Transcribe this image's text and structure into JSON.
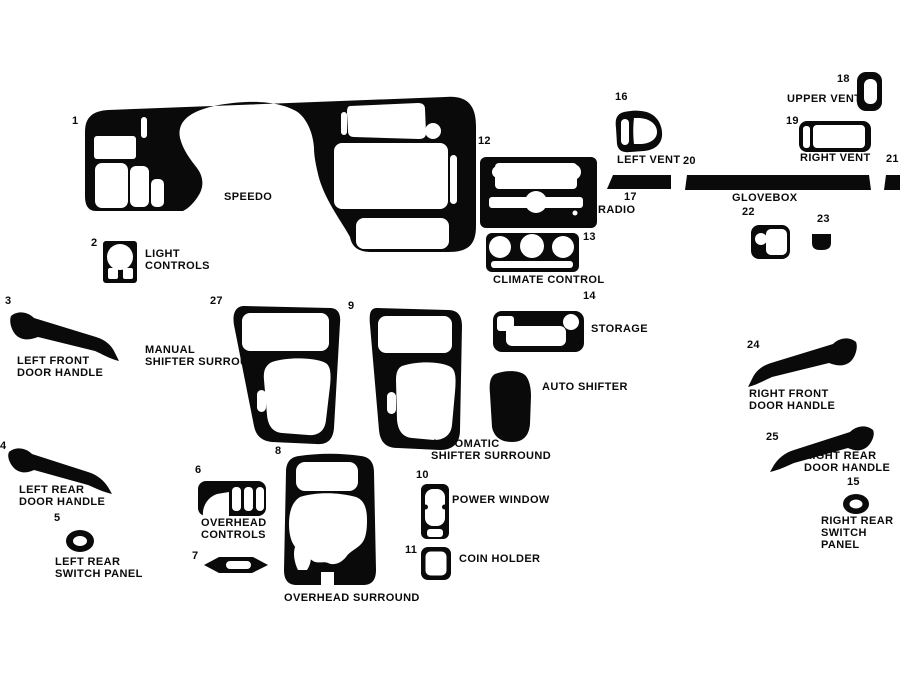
{
  "colors": {
    "background": "#ffffff",
    "ink": "#0a0a0a"
  },
  "parts": {
    "speedo": {
      "number": "1",
      "label": "SPEEDO"
    },
    "light_controls": {
      "number": "2",
      "label": "LIGHT\nCONTROLS"
    },
    "left_front_door_handle": {
      "number": "3",
      "label": "LEFT FRONT\nDOOR HANDLE"
    },
    "left_rear_door_handle": {
      "number": "4",
      "label": "LEFT REAR\nDOOR HANDLE"
    },
    "left_rear_switch_panel": {
      "number": "5",
      "label": "LEFT REAR\nSWITCH PANEL"
    },
    "overhead_controls": {
      "number": "6",
      "label": "OVERHEAD\nCONTROLS"
    },
    "strip_7": {
      "number": "7"
    },
    "overhead_surround": {
      "number": "8",
      "label": "OVERHEAD SURROUND"
    },
    "automatic_shifter_surround": {
      "number": "9",
      "label": "AUTOMATIC\nSHIFTER SURROUND"
    },
    "power_window": {
      "number": "10",
      "label": "POWER WINDOW"
    },
    "coin_holder": {
      "number": "11",
      "label": "COIN HOLDER"
    },
    "radio": {
      "number": "12",
      "label": "RADIO"
    },
    "climate_control": {
      "number": "13",
      "label": "CLIMATE CONTROL"
    },
    "storage": {
      "number": "14",
      "label": "STORAGE"
    },
    "right_rear_switch_panel": {
      "number": "15",
      "label": "RIGHT REAR\nSWITCH PANEL"
    },
    "left_vent": {
      "number": "16",
      "label": "LEFT VENT"
    },
    "strip_17": {
      "number": "17"
    },
    "upper_vent": {
      "number": "18",
      "label": "UPPER VENT"
    },
    "right_vent": {
      "number": "19",
      "label": "RIGHT VENT"
    },
    "glovebox": {
      "number": "20",
      "label": "GLOVEBOX"
    },
    "strip_21": {
      "number": "21"
    },
    "pocket_22": {
      "number": "22"
    },
    "pocket_23": {
      "number": "23"
    },
    "right_front_door_handle": {
      "number": "24",
      "label": "RIGHT FRONT\nDOOR HANDLE"
    },
    "right_rear_door_handle": {
      "number": "25",
      "label": "RIGHT REAR\nDOOR HANDLE"
    },
    "manual_shifter_surround": {
      "number": "27",
      "label": "MANUAL\nSHIFTER SURROUND"
    },
    "auto_shifter": {
      "label": "AUTO SHIFTER"
    }
  }
}
